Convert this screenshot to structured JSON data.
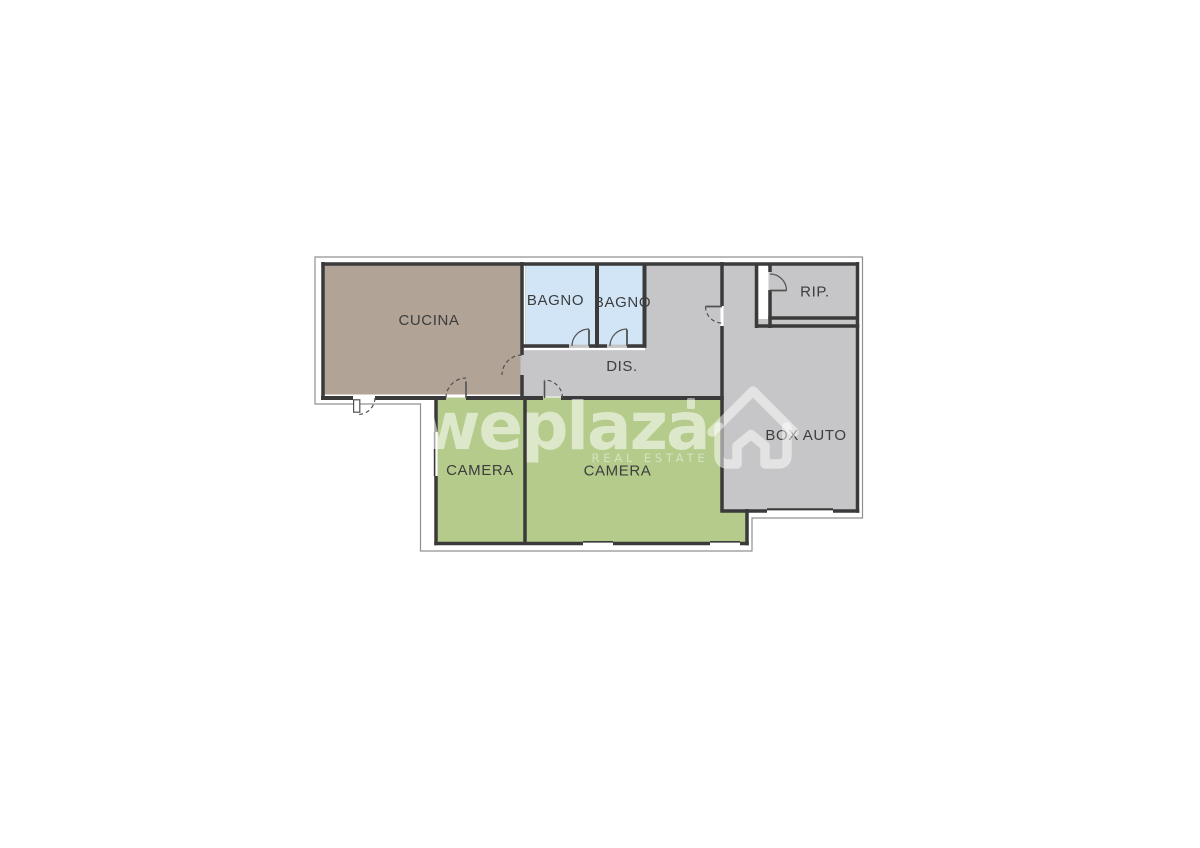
{
  "watermark": {
    "brand": "weplaza",
    "tagline": "REAL ESTATE",
    "color": "#ffffff",
    "house_icon": "house-outline-icon"
  },
  "floorplan": {
    "wall_color": "#3a3a3a",
    "outline_color": "#909090",
    "label_color": "#3d3d3d",
    "door_line_color": "#515151",
    "rooms": [
      {
        "id": "cucina",
        "label": "CUCINA",
        "fill": "#b1a396"
      },
      {
        "id": "bagno-1",
        "label": "BAGNO",
        "fill": "#d2e5f6"
      },
      {
        "id": "bagno-2",
        "label": "BAGNO",
        "fill": "#d2e5f6"
      },
      {
        "id": "disimpegno",
        "label": "DIS.",
        "fill": "#c6c6c8"
      },
      {
        "id": "ripostiglio",
        "label": "RIP.",
        "fill": "#c6c6c8"
      },
      {
        "id": "box-auto",
        "label": "BOX AUTO",
        "fill": "#c6c6c8"
      },
      {
        "id": "camera-1",
        "label": "CAMERA",
        "fill": "#b4cb8b"
      },
      {
        "id": "camera-2",
        "label": "CAMERA",
        "fill": "#b4cb8b"
      }
    ]
  }
}
